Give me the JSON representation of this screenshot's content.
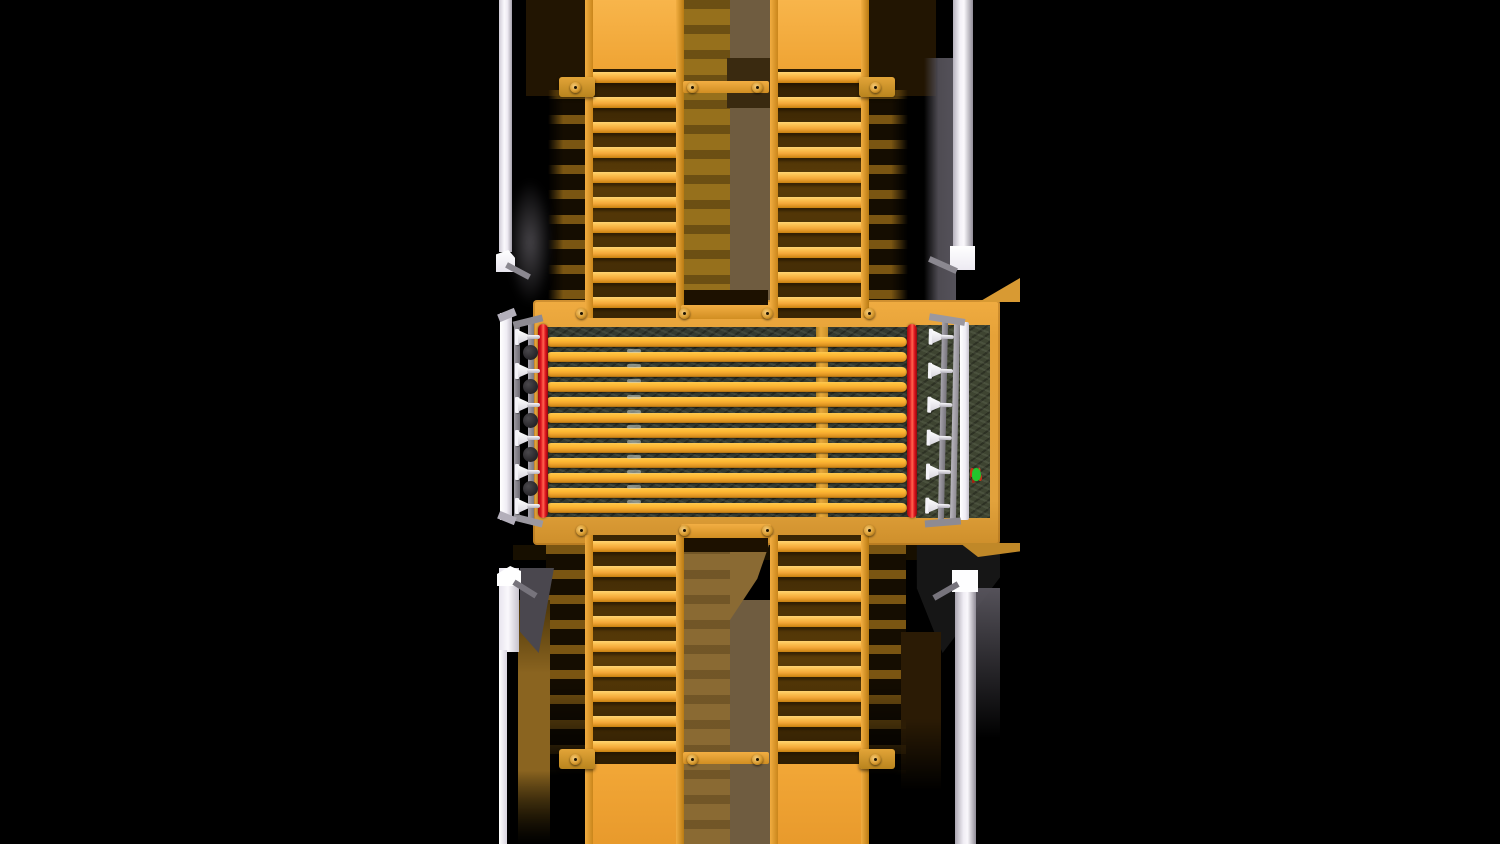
{
  "scene": {
    "width": 1500,
    "height": 844,
    "background": "#000000",
    "alt": "Top-down 3D render of an industrial drive-over wheel-wash platform: yellow roller deck over a dark pit, red side bars, white spray-nozzle rails, white corner posts, and folding yellow ladder ramps at top and bottom"
  },
  "palette": {
    "ramp_yellow": "#F2A737",
    "rung_highlight": "#FFD473",
    "deck_yellow": "#E2A23C",
    "slat_yellow": "#FDB832",
    "pit_dark": "#343A31",
    "pit_olive": "#3E4431",
    "red_bar": "#E0161F",
    "rail_gray": "#9B98A0",
    "post_white": "#FAF8FC",
    "shadow_tan": "#8A6A33",
    "shadow_gray_brown": "#6F5C40",
    "shadow_dark_brown": "#221502",
    "decal_green": "#23C62C",
    "decal_red": "#C23318"
  },
  "platform": {
    "slat_count": 12,
    "slat_period": 15.1,
    "slat_height": 10,
    "nozzle_count_per_side": 6,
    "nozzle_spacing": 33.8,
    "mount_count": 5,
    "mount_spacing": 34,
    "red_bar_count": 2
  },
  "ramps": {
    "rung_period": 25,
    "top": {
      "count": 2,
      "rungs": 10,
      "rung_offset": 3
    },
    "bottom": {
      "count": 2,
      "rungs": 9,
      "rung_offset": 6
    }
  },
  "hinge_bars": [
    {
      "y": 87,
      "pins_x": [
        575,
        692,
        757,
        875
      ]
    },
    {
      "y": 313,
      "pins_x": [
        581,
        684,
        767,
        869
      ]
    },
    {
      "y": 530,
      "pins_x": [
        581,
        684,
        767,
        869
      ]
    },
    {
      "y": 759,
      "pins_x": [
        575,
        692,
        757,
        875
      ]
    }
  ]
}
